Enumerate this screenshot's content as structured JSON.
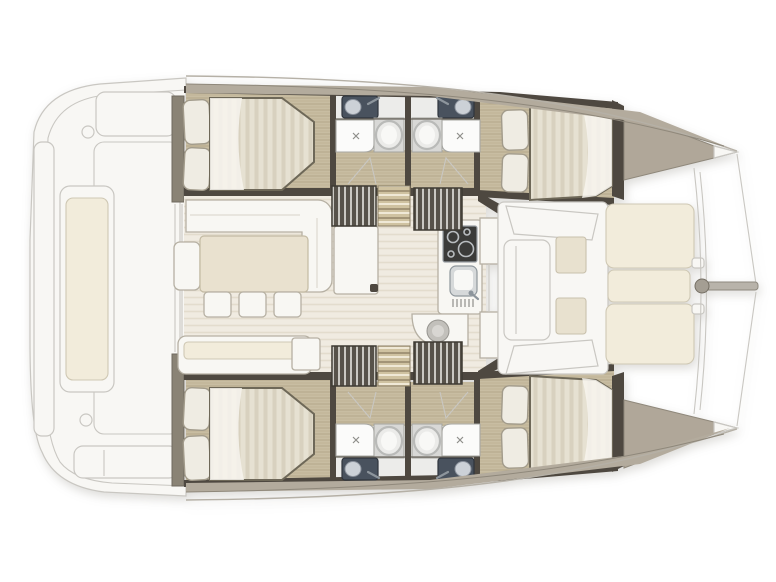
{
  "title": "Catamaran interior floor plan — top view, bow right",
  "colors": {
    "wood": "#c8bda2",
    "woodGrain": "#b3a78a",
    "wallDark": "#4e4840",
    "wallTaupe": "#8a8375",
    "deckStrip": "#b3ab9d",
    "deckEdge": "#8f887b",
    "gunwaleEdge": "#b5b0a6",
    "foredeck": "#b0a799",
    "bedBase": "#e6e1d2",
    "bedStripe": "#d8d1bf",
    "bedHighlight": "#f7f5ef",
    "pillow": "#efece3",
    "pillowEdge": "#a29b8b",
    "salonFloor": "#f0ebe1",
    "salonStripe": "#e3dccd",
    "furnitureWhite": "#f8f7f3",
    "furnitureEdge": "#b6b0a3",
    "tableTop": "#e9e1cf",
    "tableEdge": "#c3baa3",
    "cushionCream": "#f2ecdb",
    "padBeige": "#e8e1cf",
    "toiletDark": "#49525e",
    "toiletLid": "#ccd1d7",
    "vanity": "#d8d8d6",
    "sinkRim": "#b9bab8",
    "steel": "#8d959c",
    "stoveDark": "#3b3b39",
    "burner": "#b9bdc0",
    "sinkSteel": "#d6d9da",
    "headFloor": "#ececea",
    "stairDark": "#57524a",
    "stairLine": "#e8e6e1",
    "stepTan": "#cfc2a1",
    "stepLineDark": "#8f8165",
    "stepLineLight": "#efe8d6",
    "faintFill": "#f8f7f4",
    "faintLine": "#c9c7c2",
    "bowsprit": "#b8b3aa"
  },
  "vessel": {
    "type": "catamaran",
    "orientation": "bow-right",
    "areas": [
      {
        "name": "aft-cockpit",
        "features": [
          "transom-platform",
          "side-bench-with-cushion",
          "aft-bench",
          "deck-fittings"
        ]
      },
      {
        "name": "salon",
        "features": [
          "l-shaped-sofa",
          "armchair",
          "dining-table",
          "three-stools",
          "aft-sofa",
          "side-cabinet",
          "galley-stove",
          "galley-sink",
          "curved-counter",
          "cabinet"
        ]
      },
      {
        "name": "port-hull",
        "features": [
          "aft-double-berth",
          "aft-head-wc-shower-sink",
          "forward-head-wc-shower-sink",
          "forward-double-berth",
          "companionway-stairs",
          "wood-steps"
        ]
      },
      {
        "name": "starboard-hull",
        "features": [
          "aft-double-berth",
          "aft-head-wc-shower-sink",
          "forward-head-wc-shower-sink",
          "forward-double-berth",
          "companionway-stairs",
          "wood-steps"
        ]
      },
      {
        "name": "forward-cockpit",
        "features": [
          "u-shaped-seating",
          "two-seat-pads",
          "sunpad-lounge"
        ]
      },
      {
        "name": "foredeck",
        "features": [
          "port-bow",
          "starboard-bow",
          "crossbeam",
          "bowsprit",
          "rigging-lines"
        ]
      }
    ]
  }
}
